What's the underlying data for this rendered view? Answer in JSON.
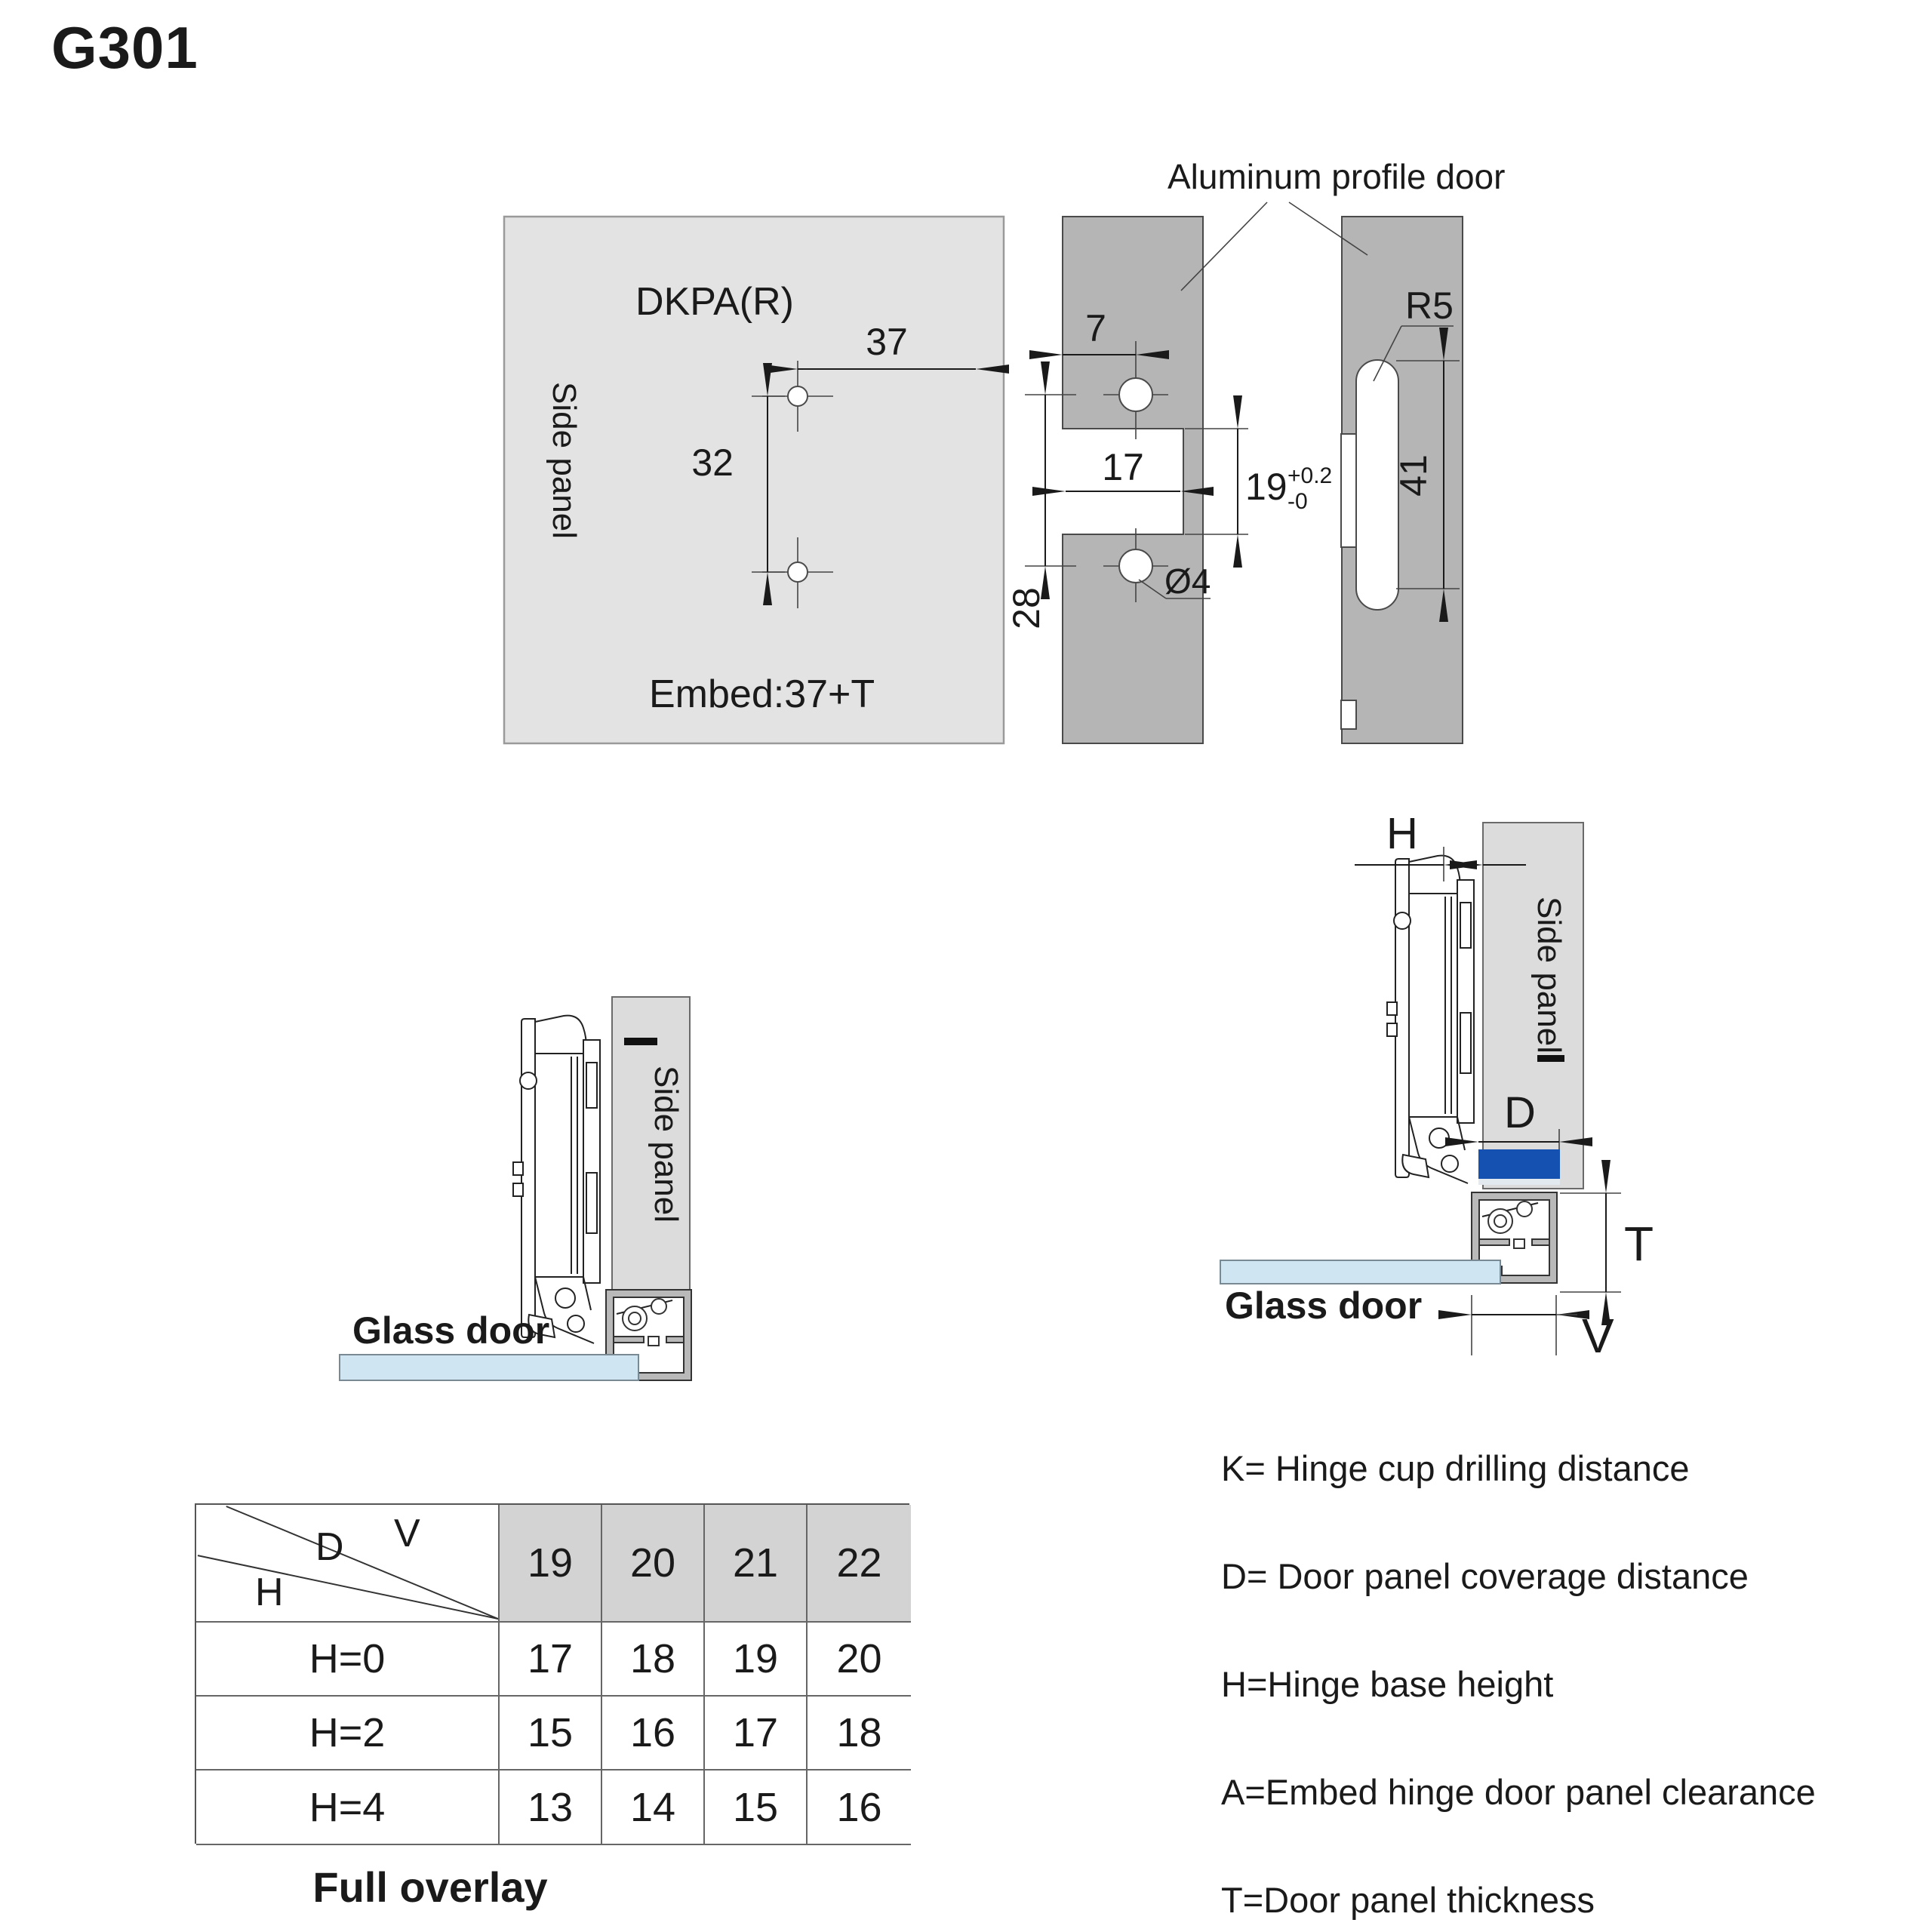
{
  "title": "G301",
  "drill_view": {
    "door_label": "Aluminum profile door",
    "plate": {
      "name": "DKPA(R)",
      "panel_label": "Side panel",
      "dim_width": "37",
      "dim_pitch": "32",
      "embed_note": "Embed:37+T"
    },
    "profile_front": {
      "dim_edge": "7",
      "dim_slot_width": "17",
      "dim_notch_height": "19",
      "tol_plus": "+0.2",
      "tol_minus": "-0",
      "dim_hole_pitch": "28",
      "dim_hole_dia": "Ø4"
    },
    "profile_side": {
      "radius": "R5",
      "dim_slot_length": "41"
    }
  },
  "assembly_left": {
    "panel_label": "Side panel",
    "glass_label": "Glass door"
  },
  "assembly_right": {
    "panel_label": "Side panel",
    "glass_label": "Glass door",
    "dim_h": "H",
    "dim_d": "D",
    "dim_t": "T",
    "dim_v": "V"
  },
  "table": {
    "corner_d": "D",
    "corner_v": "V",
    "corner_h": "H",
    "columns": [
      "19",
      "20",
      "21",
      "22"
    ],
    "rows": [
      {
        "label": "H=0",
        "values": [
          "17",
          "18",
          "19",
          "20"
        ]
      },
      {
        "label": "H=2",
        "values": [
          "15",
          "16",
          "17",
          "18"
        ]
      },
      {
        "label": "H=4",
        "values": [
          "13",
          "14",
          "15",
          "16"
        ]
      }
    ],
    "caption": "Full overlay"
  },
  "legend": {
    "items": [
      "K= Hinge cup drilling distance",
      "D= Door panel coverage distance",
      "H=Hinge base height",
      "A=Embed hinge door panel clearance",
      "T=Door panel thickness"
    ]
  },
  "colors": {
    "accent_blue": "#1551b0",
    "glass": "#cfe5f2",
    "panel_light": "#e3e3e3",
    "panel_medium": "#b5b5b5",
    "side_panel": "#dcdcdc",
    "profile_wall": "#b9b9b9",
    "table_corner": "#b2b2b2",
    "table_header": "#d3d3d3"
  }
}
